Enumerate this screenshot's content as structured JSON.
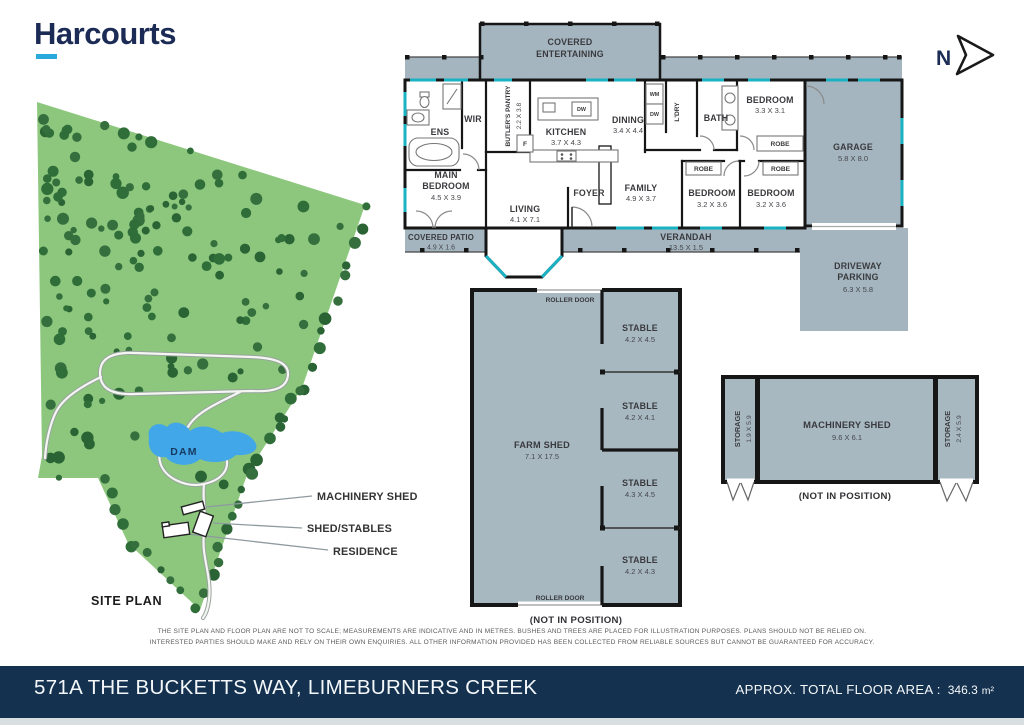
{
  "brand": {
    "name": "Harcourts"
  },
  "compass": {
    "label": "N"
  },
  "colors": {
    "brand_navy": "#1b2b55",
    "brand_cyan": "#2aa9dd",
    "footer_navy": "#14314f",
    "plan_shade": "#a4b5bf",
    "window_teal": "#1ab3c4",
    "grass_green": "#8cc77d",
    "tree_green": "#2f6d39",
    "dam_blue": "#42a7e8"
  },
  "house": {
    "covered_entertaining": {
      "line1": "COVERED",
      "line2": "ENTERTAINING"
    },
    "ens": "ENS",
    "wir": "WIR",
    "butlers_pantry": {
      "name": "BUTLER'S PANTRY",
      "dims": "2.2 X 3.8"
    },
    "kitchen": {
      "name": "KITCHEN",
      "dims": "3.7 X 4.3"
    },
    "fridge": "F",
    "wm": "WM",
    "dw": "DW",
    "dining": {
      "name": "DINING",
      "dims": "3.4 X 4.4"
    },
    "laundry": "L'DRY",
    "bath": "BATH",
    "bedroom_top": {
      "name": "BEDROOM",
      "dims": "3.3 X 3.1"
    },
    "robe": "ROBE",
    "garage": {
      "name": "GARAGE",
      "dims": "5.8 X 8.0"
    },
    "main_bedroom": {
      "line1": "MAIN",
      "line2": "BEDROOM",
      "dims": "4.5 X 3.9"
    },
    "living": {
      "name": "LIVING",
      "dims": "4.1 X 7.1"
    },
    "foyer": "FOYER",
    "family": {
      "name": "FAMILY",
      "dims": "4.9 X 3.7"
    },
    "bedroom_mid": {
      "name": "BEDROOM",
      "dims": "3.2 X 3.6"
    },
    "bedroom_right": {
      "name": "BEDROOM",
      "dims": "3.2 X 3.6"
    },
    "covered_patio": {
      "name": "COVERED PATIO",
      "dims": "4.9 X 1.6"
    },
    "verandah": {
      "name": "VERANDAH",
      "dims": "13.5 X 1.5"
    },
    "driveway": {
      "line1": "DRIVEWAY",
      "line2": "PARKING",
      "dims": "6.3 X 5.8"
    }
  },
  "farm_shed": {
    "name": "FARM SHED",
    "dims": "7.1 X 17.5",
    "roller_door": "ROLLER DOOR",
    "not_in_position": "(NOT IN POSITION)",
    "stables": [
      {
        "name": "STABLE",
        "dims": "4.2 X 4.5"
      },
      {
        "name": "STABLE",
        "dims": "4.2 X 4.1"
      },
      {
        "name": "STABLE",
        "dims": "4.3 X 4.5"
      },
      {
        "name": "STABLE",
        "dims": "4.2 X 4.3"
      }
    ]
  },
  "machinery_shed": {
    "name": "MACHINERY SHED",
    "dims": "9.6 X 6.1",
    "storage_left": {
      "name": "STORAGE",
      "dims": "1.9 X 5.9"
    },
    "storage_right": {
      "name": "STORAGE",
      "dims": "2.4 X 5.9"
    },
    "not_in_position": "(NOT IN POSITION)"
  },
  "site_plan": {
    "title": "SITE PLAN",
    "dam_label": "DAM",
    "callouts": [
      {
        "label": "MACHINERY SHED"
      },
      {
        "label": "SHED/STABLES"
      },
      {
        "label": "RESIDENCE"
      }
    ]
  },
  "disclaimer": {
    "line1": "THE SITE PLAN AND FLOOR PLAN ARE NOT TO SCALE; MEASUREMENTS ARE INDICATIVE AND IN METRES. BUSHES AND TREES ARE PLACED FOR ILLUSTRATION PURPOSES. PLANS SHOULD NOT BE RELIED ON.",
    "line2": "INTERESTED PARTIES SHOULD MAKE AND RELY ON THEIR OWN ENQUIRIES. ALL OTHER INFORMATION PROVIDED HAS BEEN COLLECTED FROM RELIABLE SOURCES BUT CANNOT BE GUARANTEED FOR ACCURACY."
  },
  "footer": {
    "address": "571A THE BUCKETTS WAY, LIMEBURNERS CREEK",
    "area_label": "APPROX. TOTAL FLOOR AREA :",
    "area_value": "346.3",
    "area_unit": "m²"
  }
}
